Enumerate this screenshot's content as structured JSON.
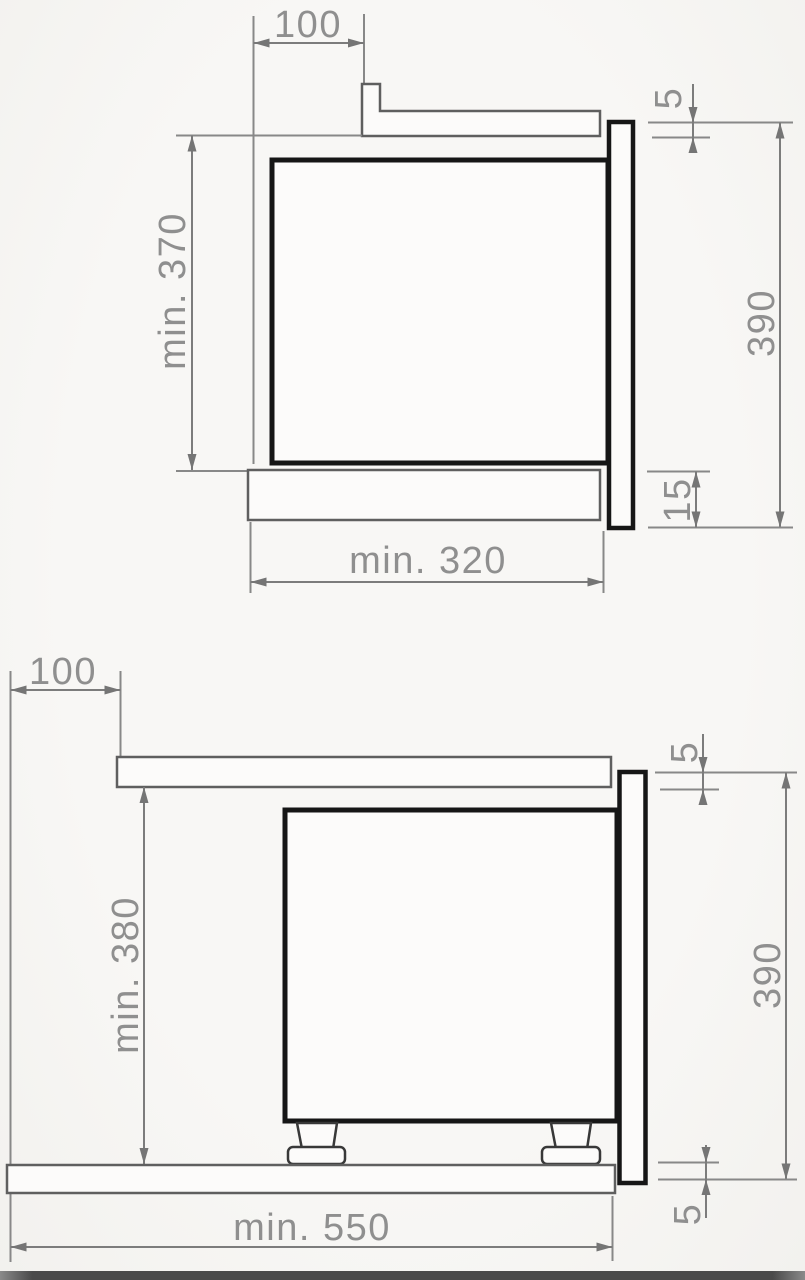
{
  "drawing": {
    "views": {
      "top": {
        "offset_top": "100",
        "niche_height_min": "min. 370",
        "top_gap": "5",
        "front_height": "390",
        "bottom_overlap": "15",
        "niche_depth_min": "min. 320"
      },
      "bottom": {
        "offset_top": "100",
        "clearance_min": "min. 380",
        "top_gap": "5",
        "front_height": "390",
        "bottom_gap": "5",
        "worktop_depth_min": "min. 550"
      }
    },
    "colors": {
      "appliance_outline": "#161616",
      "dimension_lines": "#7c7c7c",
      "label_text": "#8f8f8f",
      "background": "#f7f6f4",
      "footer_bar": "#484848"
    }
  }
}
